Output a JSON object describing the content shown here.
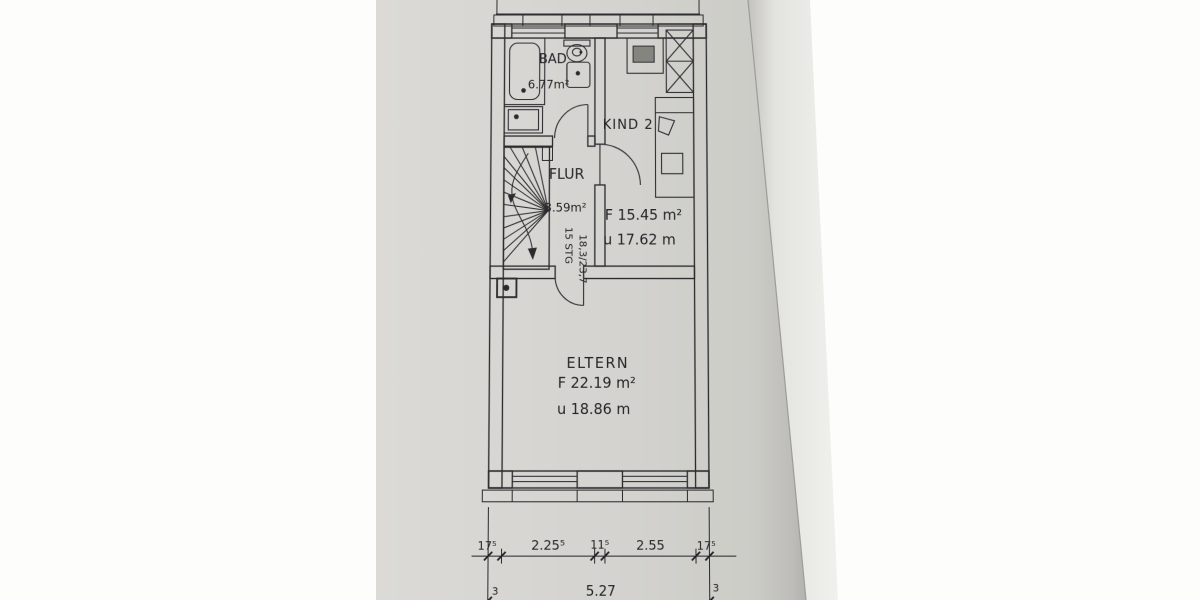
{
  "document": {
    "type": "floor-plan-photo",
    "floor": "upper floor (OG)"
  },
  "rooms": [
    {
      "label": "BAD",
      "area": "6.77m²"
    },
    {
      "label": "FLUR",
      "area": "3.59m²"
    },
    {
      "label": "KIND 2",
      "area_line": "F 15.45 m²",
      "perimeter_line": "u 17.62 m"
    },
    {
      "label": "ELTERN",
      "area_line": "F 22.19 m²",
      "perimeter_line": "u 18.86 m"
    }
  ],
  "stair": {
    "steps_label": "15 STG",
    "rise_run": "18,3/23,7"
  },
  "dimensions": {
    "segments": [
      "17⁵",
      "2.25⁵",
      "11⁵",
      "2.55",
      "17⁵"
    ],
    "total": "5.27",
    "left_offset": "3",
    "right_offset": "3"
  },
  "colors": {
    "paper": "#d5d4d0",
    "paper_edge_sheet": "#ebebe7",
    "ink": "#2b2b2e"
  }
}
